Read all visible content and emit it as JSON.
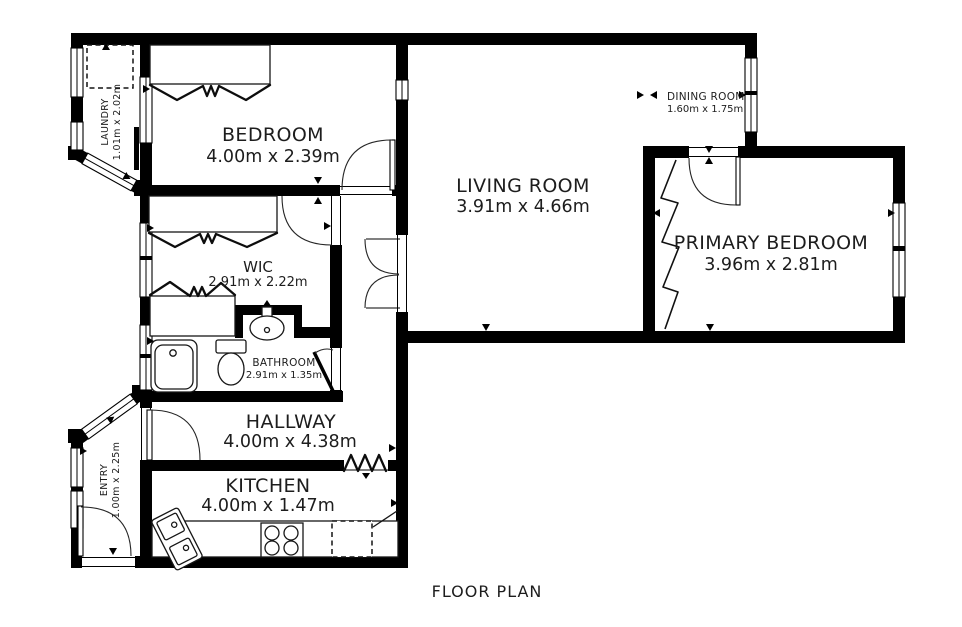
{
  "title": "FLOOR PLAN",
  "colors": {
    "wall": "#000000",
    "text": "#1d1d1d",
    "background": "#ffffff"
  },
  "rooms": {
    "bedroom": {
      "name": "BEDROOM",
      "dims": "4.00m x 2.39m"
    },
    "living_room": {
      "name": "LIVING ROOM",
      "dims": "3.91m x 4.66m"
    },
    "dining_room": {
      "name": "DINING ROOM",
      "dims": "1.60m x 1.75m"
    },
    "primary_bedroom": {
      "name": "PRIMARY BEDROOM",
      "dims": "3.96m x 2.81m"
    },
    "wic": {
      "name": "WIC",
      "dims": "2.91m x 2.22m"
    },
    "bathroom": {
      "name": "BATHROOM",
      "dims": "2.91m x 1.35m"
    },
    "hallway": {
      "name": "HALLWAY",
      "dims": "4.00m x 4.38m"
    },
    "kitchen": {
      "name": "KITCHEN",
      "dims": "4.00m x 1.47m"
    },
    "laundry": {
      "name": "LAUNDRY",
      "dims": "1.01m x 2.02m"
    },
    "entry": {
      "name": "ENTRY",
      "dims": "1.00m x 2.25m"
    }
  }
}
